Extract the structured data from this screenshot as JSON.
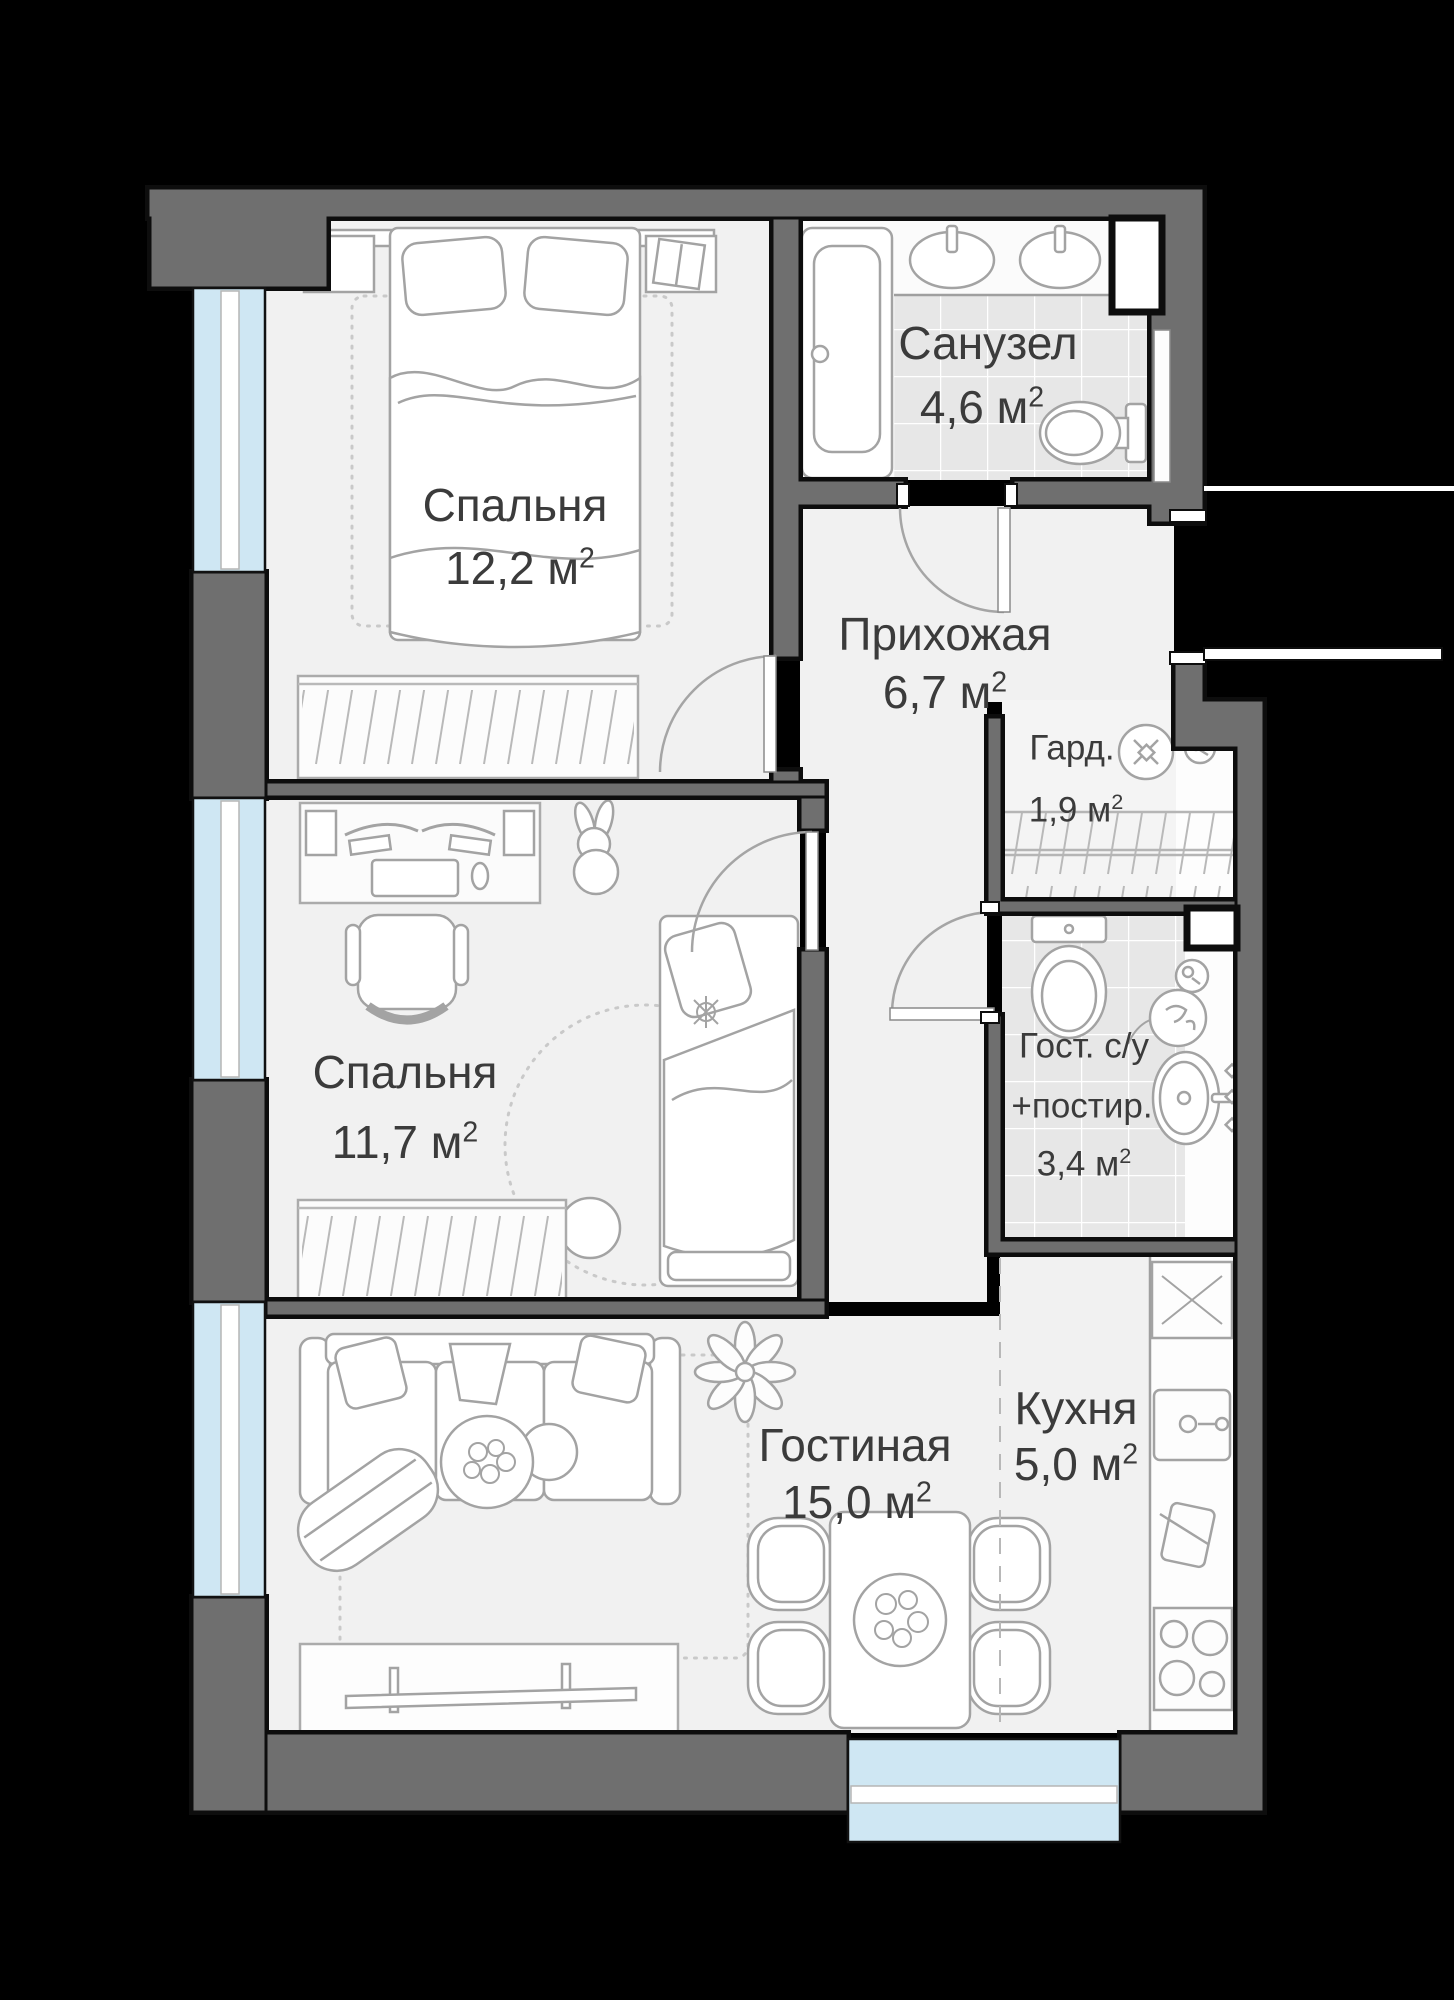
{
  "plan": {
    "rooms": [
      {
        "id": "bedroom1",
        "name": "Спальня",
        "area_value": "12,2",
        "area_unit": " м",
        "area_sup": "2"
      },
      {
        "id": "bathroom",
        "name": "Санузел",
        "area_value": "4,6",
        "area_unit": " м",
        "area_sup": "2"
      },
      {
        "id": "hallway",
        "name": "Прихожая",
        "area_value": "6,7",
        "area_unit": " м",
        "area_sup": "2"
      },
      {
        "id": "wardrobe",
        "name": "Гард.",
        "area_value": "1,9",
        "area_unit": " м",
        "area_sup": "2"
      },
      {
        "id": "bedroom2",
        "name": "Спальня",
        "area_value": "11,7",
        "area_unit": " м",
        "area_sup": "2"
      },
      {
        "id": "guest_wc",
        "name": "Гост. с/у",
        "name2": "+постир.",
        "area_value": "3,4",
        "area_unit": " м",
        "area_sup": "2"
      },
      {
        "id": "living",
        "name": "Гостиная",
        "area_value": "15,0",
        "area_unit": " м",
        "area_sup": "2"
      },
      {
        "id": "kitchen",
        "name": "Кухня",
        "area_value": "5,0",
        "area_unit": " м",
        "area_sup": "2"
      }
    ],
    "colors": {
      "background": "#000000",
      "wall_fill": "#6f6f6f",
      "wall_outline": "#0d0d0d",
      "window_glass": "#cfe7f3",
      "floor": "#f1f1f1",
      "tile_floor": "#e7e7e7",
      "furniture_line": "#a3a3a3",
      "label_text": "#3b3b3b"
    }
  }
}
